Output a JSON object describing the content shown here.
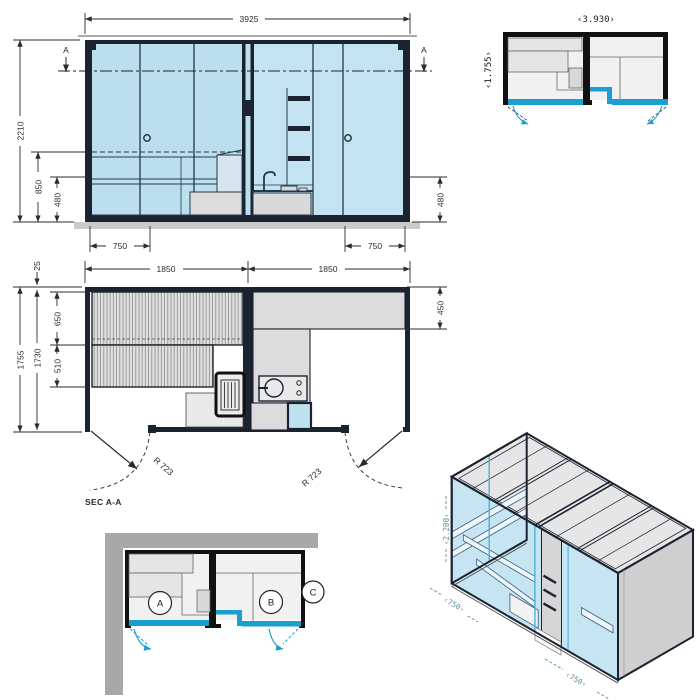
{
  "elevation": {
    "width": "3925",
    "height": "2210",
    "bench_height": "850",
    "seat_height_left": "480",
    "seat_height_right": "480",
    "door_width_left": "750",
    "door_width_right": "750",
    "section_left": "A",
    "section_right": "A"
  },
  "plan": {
    "module_left": "1850",
    "module_right": "1850",
    "wall_offset": "25",
    "depth_outer": "1755",
    "depth_inner": "1730",
    "bench_deep": "650",
    "bench_shallow": "510",
    "bench_right": "450",
    "swing_left": "R 723",
    "swing_right": "R 723",
    "section_label": "SEC A-A"
  },
  "overview": {
    "width": "‹3.930›",
    "depth": "‹1.755›"
  },
  "corner": {
    "room_a": "A",
    "room_b": "B",
    "room_c": "C"
  },
  "iso": {
    "height": "‹2.200›",
    "width_left": "‹750›",
    "width_front": "‹750›"
  },
  "colors": {
    "line": "#1c2330",
    "glass": "#bcdfee",
    "glass_light": "#c9e6f2",
    "panel": "#d9d9d9",
    "panel_light": "#ececec",
    "wall_gray": "#a8a8a8",
    "accent_cyan": "#1b9fd0",
    "dim_teal": "#5f8fa0",
    "dim_text": "#2b2b2b"
  }
}
